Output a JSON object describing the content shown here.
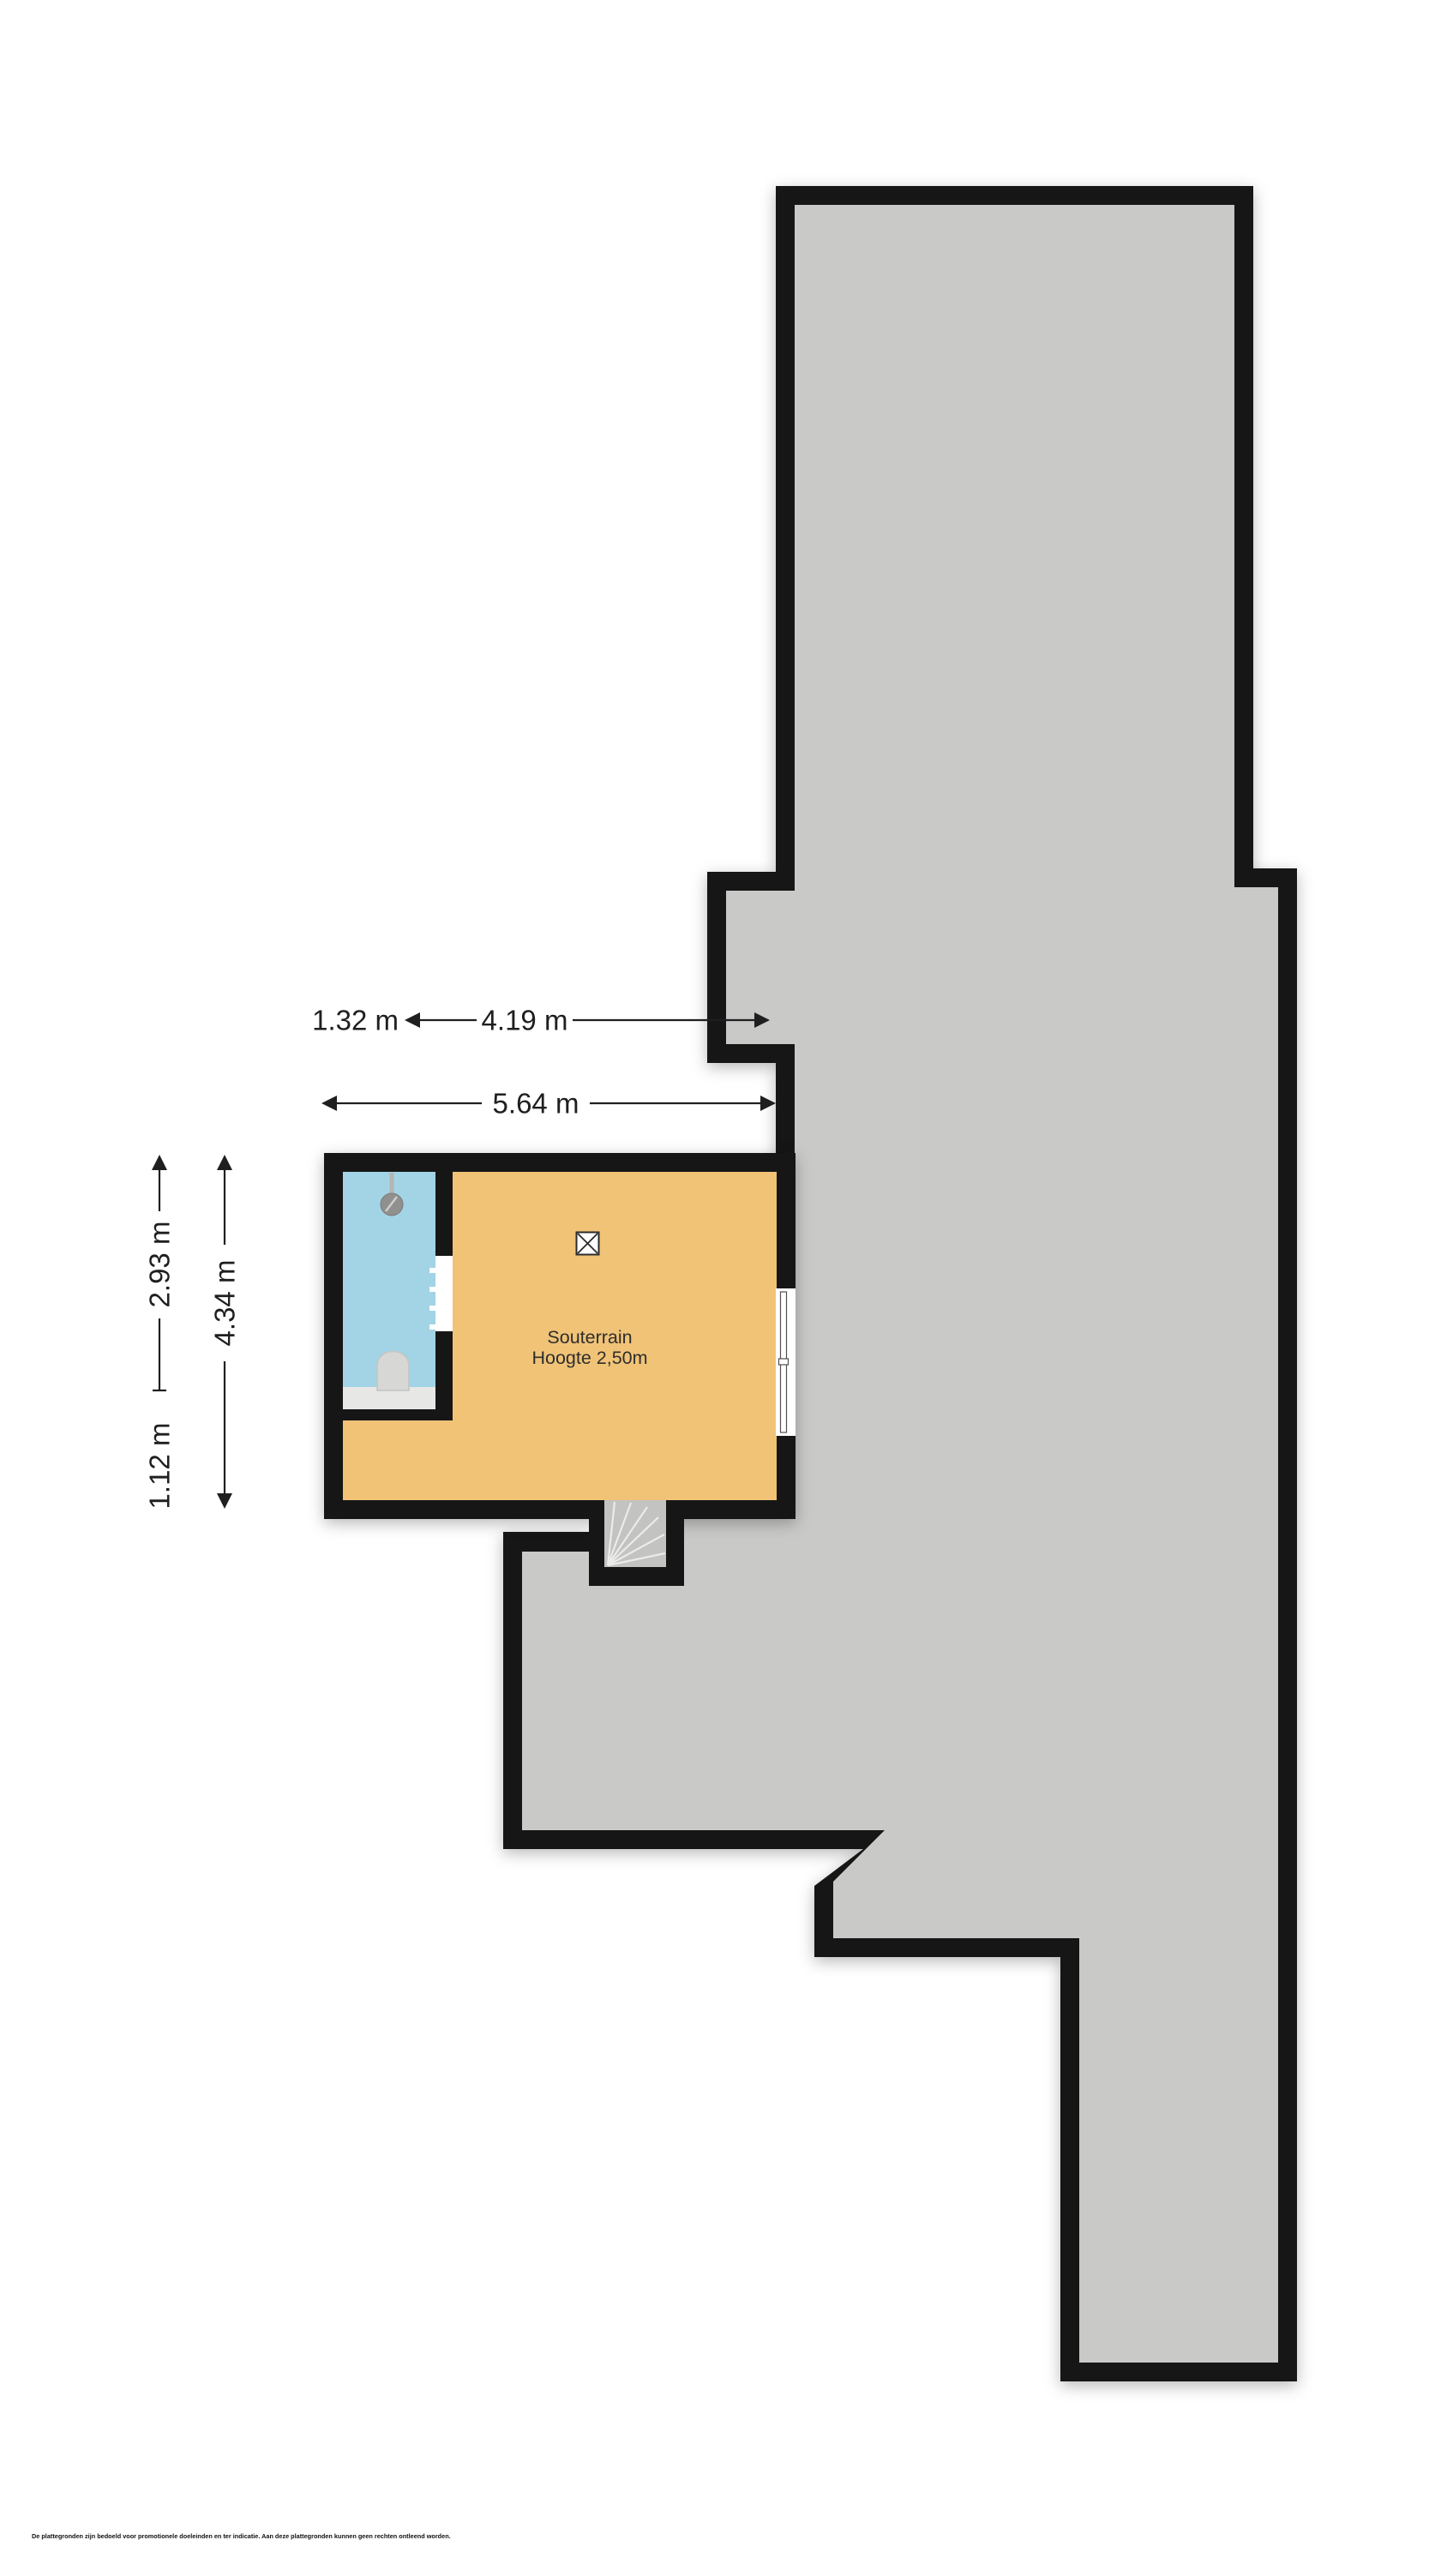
{
  "room": {
    "label": "Souterrain",
    "height_note": "Hoogte 2,50m"
  },
  "dims": {
    "left_width": "1.32 m",
    "right_width": "4.19 m",
    "total_width": "5.64 m",
    "upper_height": "2.93 m",
    "lower_height": "1.12 m",
    "total_height": "4.34 m"
  },
  "disclaimer": "De plattegronden zijn bedoeld voor promotionele doeleinden en ter indicatie. Aan deze plattegronden kunnen geen rechten ontleend worden.",
  "colors": {
    "wall": "#161616",
    "building_mass": "#c9c9c7",
    "room_floor": "#f0c377",
    "bathroom_floor": "#a2d4e6",
    "stairs": "#c3c3c1",
    "background": "#ffffff",
    "annotation": "#1f1f1f"
  },
  "icons": {
    "ventilation": "boxed-x-icon",
    "shower": "shower-head-icon",
    "toilet": "toilet-icon",
    "stairs": "winder-stairs-icon",
    "window": "window-symbol",
    "door": "door-opening-symbol"
  }
}
